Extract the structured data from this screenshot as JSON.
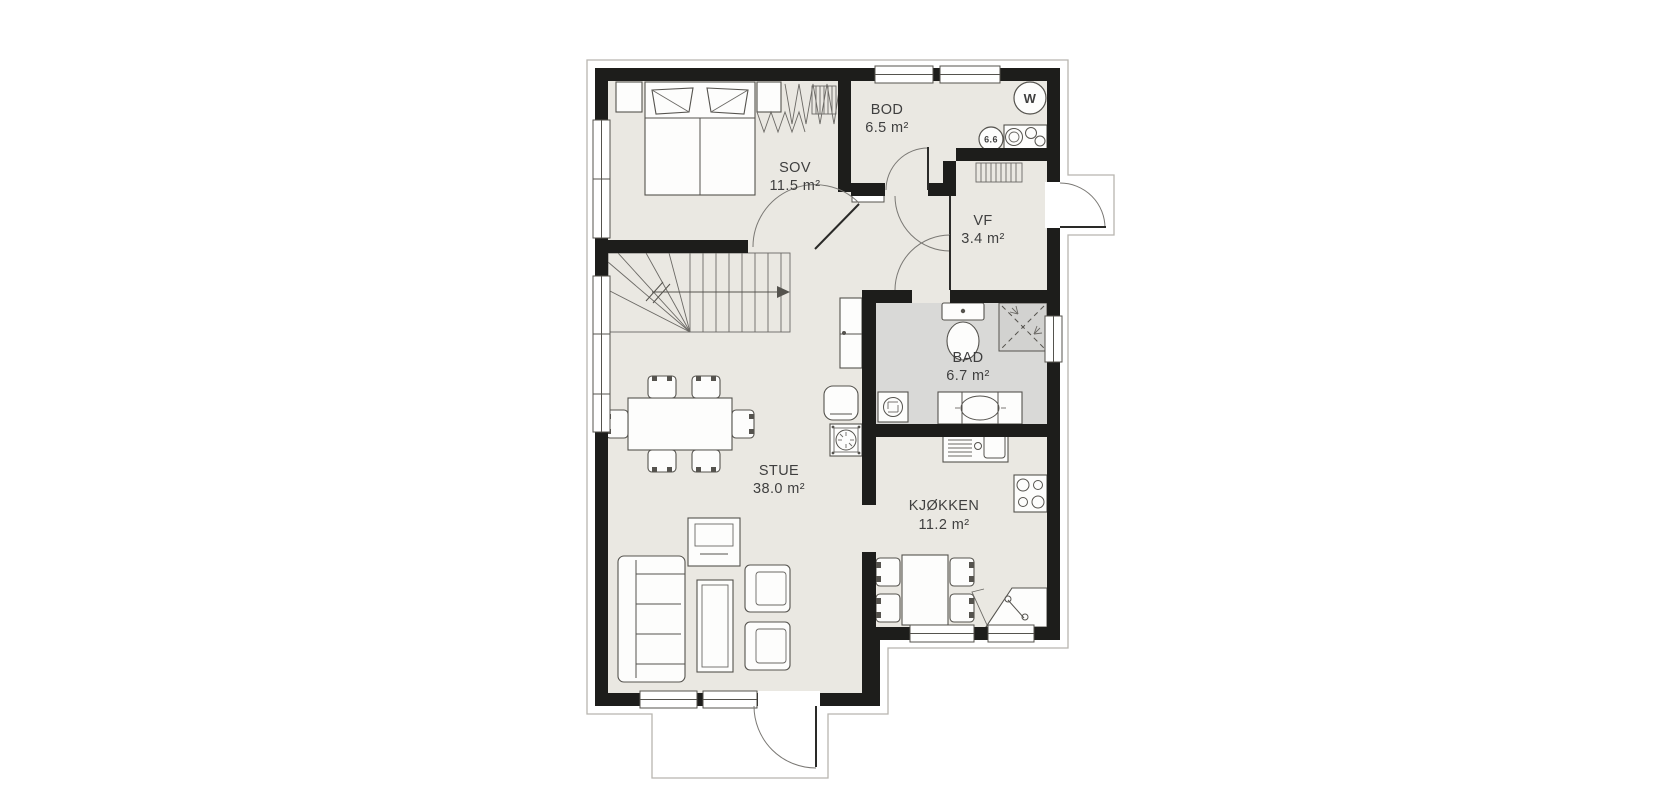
{
  "plan": {
    "title": "floor-plan",
    "rooms": {
      "sov": {
        "name": "SOV",
        "area": "11.5 m²"
      },
      "bod": {
        "name": "BOD",
        "area": "6.5 m²"
      },
      "vf": {
        "name": "VF",
        "area": "3.4 m²"
      },
      "bad": {
        "name": "BAD",
        "area": "6.7 m²"
      },
      "stue": {
        "name": "STUE",
        "area": "38.0 m²"
      },
      "kjokken": {
        "name": "KJØKKEN",
        "area": "11.2 m²"
      }
    },
    "badges": {
      "water_heater": "W",
      "vent": "6.6"
    },
    "colors": {
      "wall": "#1d1d1b",
      "floor": "#eae8e2",
      "bath_floor": "#d9d9d7",
      "outline": "#b8b5af",
      "furniture_stroke": "#55534e",
      "label": "#3f3f3f",
      "background": "#ffffff"
    }
  }
}
